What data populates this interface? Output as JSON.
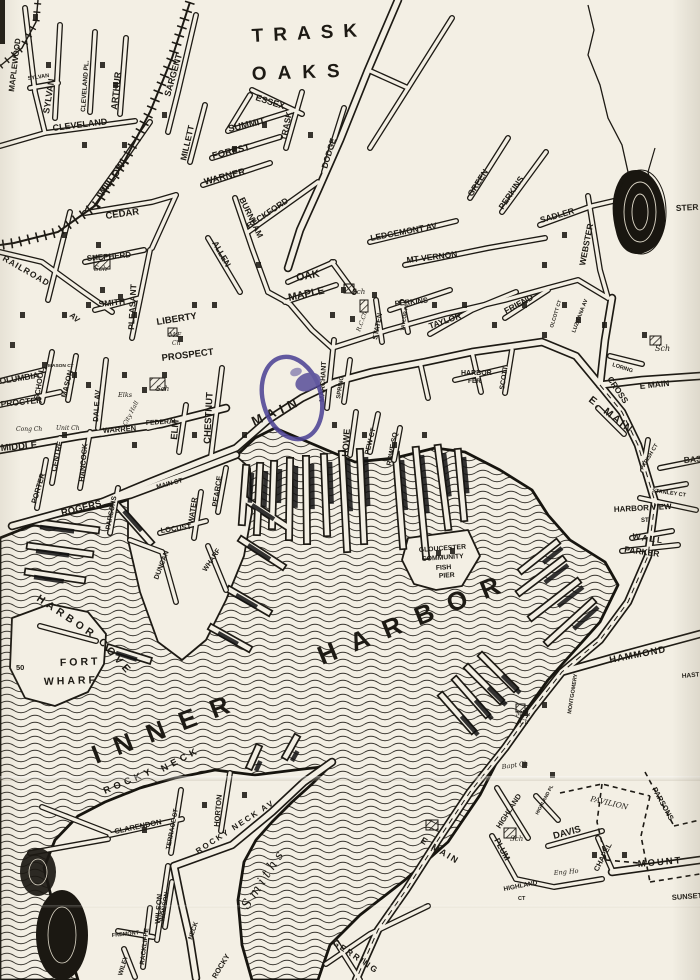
{
  "map": {
    "title": "Hand-drawn street map of Gloucester Inner Harbor",
    "colors": {
      "paper": "#f3efe4",
      "ink": "#1d1a14",
      "water_contour": "#2b2822",
      "stamp": "#4f4596"
    },
    "water_bodies": [
      "INNER HARBOR",
      "HARBOR COVE",
      "SMITHS (cove)"
    ],
    "labels": [
      {
        "t": "TRASK",
        "x": 252,
        "y": 42,
        "r": -3,
        "s": 19,
        "sp": 10
      },
      {
        "t": "OAKS",
        "x": 252,
        "y": 80,
        "r": -2,
        "s": 19,
        "sp": 11
      },
      {
        "t": "MAPLEWOOD",
        "x": 14,
        "y": 92,
        "r": -83,
        "s": 8
      },
      {
        "t": "SYLVAN",
        "x": 28,
        "y": 80,
        "r": -8,
        "s": 5.5
      },
      {
        "t": "SYLVAN",
        "x": 49,
        "y": 114,
        "r": -81,
        "s": 9
      },
      {
        "t": "CLEVELAND PL.",
        "x": 85,
        "y": 112,
        "r": -86,
        "s": 6.5
      },
      {
        "t": "ARTHUR",
        "x": 117,
        "y": 110,
        "r": -84,
        "s": 9
      },
      {
        "t": "CLEVELAND",
        "x": 53,
        "y": 131,
        "r": -7,
        "s": 9
      },
      {
        "t": "WILLOW",
        "x": 103,
        "y": 197,
        "r": -55,
        "s": 9.5
      },
      {
        "t": "SARGENT",
        "x": 170,
        "y": 97,
        "r": -74,
        "s": 9
      },
      {
        "t": "MILLETT",
        "x": 186,
        "y": 161,
        "r": -77,
        "s": 8.5
      },
      {
        "t": "ESSEX",
        "x": 255,
        "y": 100,
        "r": 18,
        "s": 9
      },
      {
        "t": "SUMMIT",
        "x": 229,
        "y": 132,
        "r": -13,
        "s": 9.5
      },
      {
        "t": "FOREST",
        "x": 213,
        "y": 159,
        "r": -14,
        "s": 9.5
      },
      {
        "t": "WARNER",
        "x": 205,
        "y": 185,
        "r": -15,
        "s": 9.5
      },
      {
        "t": "TRASK",
        "x": 286,
        "y": 141,
        "r": -78,
        "s": 8.5
      },
      {
        "t": "DODGE",
        "x": 327,
        "y": 169,
        "r": -73,
        "s": 8.5
      },
      {
        "t": "BECKFORD",
        "x": 249,
        "y": 229,
        "r": -34,
        "s": 8.5
      },
      {
        "t": "BURNHAM",
        "x": 239,
        "y": 199,
        "r": 64,
        "s": 8.5
      },
      {
        "t": "CEDAR",
        "x": 106,
        "y": 219,
        "r": -8,
        "s": 9.5
      },
      {
        "t": "SHEPHERD",
        "x": 87,
        "y": 261,
        "r": -5,
        "s": 8
      },
      {
        "t": "SMITH",
        "x": 99,
        "y": 307,
        "r": -6,
        "s": 8.5
      },
      {
        "t": "RAILROAD",
        "x": 2,
        "y": 260,
        "r": 30,
        "s": 8.5,
        "sp": 1
      },
      {
        "t": "AV",
        "x": 69,
        "y": 316,
        "r": 42,
        "s": 8
      },
      {
        "t": "PLEASANT",
        "x": 134,
        "y": 330,
        "r": -87,
        "s": 8.5
      },
      {
        "t": "ALLEN",
        "x": 212,
        "y": 243,
        "r": 60,
        "s": 8.5
      },
      {
        "t": "OAK",
        "x": 297,
        "y": 281,
        "r": -11,
        "s": 10.5
      },
      {
        "t": "MAPLE",
        "x": 289,
        "y": 301,
        "r": -12,
        "s": 10.5
      },
      {
        "t": "LEDGEMONT AV",
        "x": 371,
        "y": 241,
        "r": -11,
        "s": 8.5
      },
      {
        "t": "MT VERNON",
        "x": 407,
        "y": 263,
        "r": -7,
        "s": 8.5
      },
      {
        "t": "GREEN",
        "x": 472,
        "y": 197,
        "r": -57,
        "s": 8.5
      },
      {
        "t": "PERKINS",
        "x": 503,
        "y": 210,
        "r": -56,
        "s": 8.5
      },
      {
        "t": "SADLER",
        "x": 541,
        "y": 223,
        "r": -16,
        "s": 8.5
      },
      {
        "t": "WEBSTER",
        "x": 585,
        "y": 266,
        "r": -79,
        "s": 8.5
      },
      {
        "t": "STER",
        "x": 676,
        "y": 211,
        "r": -3,
        "s": 8.5
      },
      {
        "t": "LIBERTY",
        "x": 157,
        "y": 325,
        "r": -9,
        "s": 9.5
      },
      {
        "t": "PROSPECT",
        "x": 162,
        "y": 361,
        "r": -7,
        "s": 9.5
      },
      {
        "t": "M.E.",
        "x": 169,
        "y": 337,
        "r": 0,
        "s": 6,
        "f": "script"
      },
      {
        "t": "Ch",
        "x": 172,
        "y": 345,
        "r": 0,
        "s": 6,
        "f": "script"
      },
      {
        "t": "Sch",
        "x": 94,
        "y": 271,
        "r": 0,
        "s": 7,
        "f": "script"
      },
      {
        "t": "Sch",
        "x": 352,
        "y": 294,
        "r": 0,
        "s": 7,
        "f": "script"
      },
      {
        "t": "R.C.Ch",
        "x": 360,
        "y": 332,
        "r": -70,
        "s": 6,
        "f": "script"
      },
      {
        "t": "PERKINS",
        "x": 395,
        "y": 306,
        "r": -6,
        "s": 7.5
      },
      {
        "t": "STATEN",
        "x": 377,
        "y": 340,
        "r": -79,
        "s": 7
      },
      {
        "t": "TAYLOR",
        "x": 430,
        "y": 329,
        "r": -19,
        "s": 8.5
      },
      {
        "t": "TAYLOR PL",
        "x": 404,
        "y": 331,
        "r": -81,
        "s": 5
      },
      {
        "t": "FRIEND",
        "x": 506,
        "y": 314,
        "r": -28,
        "s": 8.5
      },
      {
        "t": "OLCOTT CT",
        "x": 553,
        "y": 328,
        "r": -73,
        "s": 5
      },
      {
        "t": "LUZITANA AV",
        "x": 575,
        "y": 333,
        "r": -69,
        "s": 5.5
      },
      {
        "t": "MARCHANT",
        "x": 324,
        "y": 402,
        "r": -87,
        "s": 7
      },
      {
        "t": "SPRING",
        "x": 340,
        "y": 399,
        "r": -81,
        "s": 6
      },
      {
        "t": "MAIN",
        "x": 254,
        "y": 426,
        "r": -24,
        "s": 13,
        "sp": 5
      },
      {
        "t": "MAIN ST",
        "x": 157,
        "y": 489,
        "r": -15,
        "s": 6.5
      },
      {
        "t": "HOWE",
        "x": 348,
        "y": 457,
        "r": -86,
        "s": 9
      },
      {
        "t": "PEW CT",
        "x": 369,
        "y": 455,
        "r": -76,
        "s": 7
      },
      {
        "t": "ROWE SQ",
        "x": 391,
        "y": 466,
        "r": -79,
        "s": 7
      },
      {
        "t": "HARBOR",
        "x": 461,
        "y": 375,
        "r": 0,
        "s": 7
      },
      {
        "t": "FER",
        "x": 468,
        "y": 383,
        "r": 0,
        "s": 6.5
      },
      {
        "t": "SCOTT",
        "x": 504,
        "y": 390,
        "r": -81,
        "s": 7
      },
      {
        "t": "E MAIN",
        "x": 640,
        "y": 389,
        "r": -6,
        "s": 8.5
      },
      {
        "t": "CROSS",
        "x": 607,
        "y": 379,
        "r": 56,
        "s": 8.5
      },
      {
        "t": "LORING",
        "x": 612,
        "y": 366,
        "r": 18,
        "s": 5.5
      },
      {
        "t": "Sch",
        "x": 655,
        "y": 351,
        "r": 0,
        "s": 8,
        "f": "script"
      },
      {
        "t": "E. MAIN",
        "x": 588,
        "y": 401,
        "r": 38,
        "s": 10.5,
        "sp": 2
      },
      {
        "t": "BASS",
        "x": 684,
        "y": 463,
        "r": -5,
        "s": 8.5
      },
      {
        "t": "COLUMBIA",
        "x": -6,
        "y": 385,
        "r": -9,
        "s": 8.5
      },
      {
        "t": "PROCTER",
        "x": 1,
        "y": 407,
        "r": -6,
        "s": 8.5
      },
      {
        "t": "MIDDLE",
        "x": 1,
        "y": 451,
        "r": -5,
        "s": 9.5
      },
      {
        "t": "SCHOOL",
        "x": 39,
        "y": 400,
        "r": -81,
        "s": 7.5
      },
      {
        "t": "MASON CT",
        "x": 48,
        "y": 367,
        "r": 0,
        "s": 4.8
      },
      {
        "t": "MASON",
        "x": 66,
        "y": 398,
        "r": -76,
        "s": 7.5
      },
      {
        "t": "DALE AV",
        "x": 98,
        "y": 422,
        "r": -86,
        "s": 7.5
      },
      {
        "t": "Elks",
        "x": 118,
        "y": 397,
        "r": 0,
        "s": 6.5,
        "f": "script"
      },
      {
        "t": "City Hall",
        "x": 126,
        "y": 426,
        "r": -62,
        "s": 6,
        "f": "script"
      },
      {
        "t": "WARREN",
        "x": 103,
        "y": 433,
        "r": -4,
        "s": 7.5
      },
      {
        "t": "FEDERAL",
        "x": 146,
        "y": 425,
        "r": -3,
        "s": 6.8
      },
      {
        "t": "ELM",
        "x": 177,
        "y": 440,
        "r": -85,
        "s": 9.5
      },
      {
        "t": "CHESTNUT",
        "x": 210,
        "y": 444,
        "r": -87,
        "s": 9.5
      },
      {
        "t": "Sch",
        "x": 156,
        "y": 391,
        "r": 0,
        "s": 7,
        "f": "script"
      },
      {
        "t": "Cong Ch",
        "x": 16,
        "y": 431,
        "r": 0,
        "s": 6,
        "f": "script"
      },
      {
        "t": "Unit Ch",
        "x": 56,
        "y": 430,
        "r": 0,
        "s": 6,
        "f": "script"
      },
      {
        "t": "CENTRE",
        "x": 56,
        "y": 472,
        "r": -78,
        "s": 7.5
      },
      {
        "t": "HANCOCK",
        "x": 84,
        "y": 482,
        "r": -85,
        "s": 7.5
      },
      {
        "t": "PORTER",
        "x": 36,
        "y": 504,
        "r": -73,
        "s": 7.5
      },
      {
        "t": "ROGERS",
        "x": 62,
        "y": 516,
        "r": -14,
        "s": 9.5
      },
      {
        "t": "PARSONS",
        "x": 110,
        "y": 530,
        "r": -79,
        "s": 7
      },
      {
        "t": "LOCUST",
        "x": 161,
        "y": 533,
        "r": -8,
        "s": 7.5
      },
      {
        "t": "WATER",
        "x": 193,
        "y": 524,
        "r": -81,
        "s": 7.5
      },
      {
        "t": "PEARCE",
        "x": 217,
        "y": 507,
        "r": -81,
        "s": 7.5
      },
      {
        "t": "WHARF",
        "x": 206,
        "y": 572,
        "r": -56,
        "s": 7
      },
      {
        "t": "DUNCAN",
        "x": 158,
        "y": 580,
        "r": -69,
        "s": 7
      },
      {
        "t": "HARBOR",
        "x": 36,
        "y": 600,
        "r": 34,
        "s": 10.5,
        "sp": 4
      },
      {
        "t": "COVE",
        "x": 98,
        "y": 642,
        "r": 48,
        "s": 10.5,
        "sp": 4
      },
      {
        "t": "FORT",
        "x": 60,
        "y": 666,
        "r": -2,
        "s": 10.5,
        "sp": 3
      },
      {
        "t": "WHARF",
        "x": 44,
        "y": 685,
        "r": -2,
        "s": 10.5,
        "sp": 3
      },
      {
        "t": "50",
        "x": 16,
        "y": 670,
        "r": 0,
        "s": 7.5
      },
      {
        "t": "GLOUCESTER",
        "x": 419,
        "y": 552,
        "r": -4,
        "s": 6.8
      },
      {
        "t": "COMMUNITY",
        "x": 422,
        "y": 561,
        "r": -4,
        "s": 6.8
      },
      {
        "t": "FISH",
        "x": 436,
        "y": 570,
        "r": -4,
        "s": 6.8
      },
      {
        "t": "PIER",
        "x": 439,
        "y": 578,
        "r": -4,
        "s": 6.8
      },
      {
        "t": "INNER",
        "x": 96,
        "y": 764,
        "r": -21,
        "s": 26,
        "sp": 16
      },
      {
        "t": "HARBOR",
        "x": 322,
        "y": 665,
        "r": -22,
        "s": 26,
        "sp": 16
      },
      {
        "t": "HARBOR VIEW",
        "x": 614,
        "y": 512,
        "r": -3,
        "s": 8
      },
      {
        "t": "ST",
        "x": 641,
        "y": 522,
        "r": 0,
        "s": 6
      },
      {
        "t": "WALL",
        "x": 632,
        "y": 539,
        "r": 8,
        "s": 8.5,
        "sp": 2
      },
      {
        "t": "PARKER",
        "x": 624,
        "y": 552,
        "r": 8,
        "s": 8.5
      },
      {
        "t": "STANLEY CT",
        "x": 652,
        "y": 492,
        "r": 8,
        "s": 5.5
      },
      {
        "t": "PARISH CT",
        "x": 643,
        "y": 470,
        "r": -59,
        "s": 5.5
      },
      {
        "t": "HAMMOND",
        "x": 610,
        "y": 663,
        "r": -11,
        "s": 9.5,
        "sp": 1
      },
      {
        "t": "HAST",
        "x": 682,
        "y": 678,
        "r": -5,
        "s": 6.5
      },
      {
        "t": "M.E.",
        "x": 516,
        "y": 716,
        "r": 0,
        "s": 6,
        "f": "script"
      },
      {
        "t": "Ch",
        "x": 520,
        "y": 724,
        "r": 0,
        "s": 6,
        "f": "script"
      },
      {
        "t": "Bapt Ch",
        "x": 502,
        "y": 769,
        "r": -8,
        "s": 6.5,
        "f": "script"
      },
      {
        "t": "MONTGOMERY",
        "x": 571,
        "y": 714,
        "r": -81,
        "s": 5.5
      },
      {
        "t": "CHAPEL",
        "x": 598,
        "y": 872,
        "r": -63,
        "s": 7.5
      },
      {
        "t": "MOUNT",
        "x": 638,
        "y": 867,
        "r": -5,
        "s": 9.5,
        "sp": 2
      },
      {
        "t": "DAVIS",
        "x": 554,
        "y": 839,
        "r": -15,
        "s": 9.5
      },
      {
        "t": "PLUM",
        "x": 494,
        "y": 840,
        "r": 62,
        "s": 8.5
      },
      {
        "t": "HIGHLAND",
        "x": 500,
        "y": 829,
        "r": -57,
        "s": 7.5
      },
      {
        "t": "HIGHLAND PL",
        "x": 538,
        "y": 815,
        "r": -62,
        "s": 4.8
      },
      {
        "t": "Sch",
        "x": 510,
        "y": 841,
        "r": 0,
        "s": 7,
        "f": "script"
      },
      {
        "t": "Eng Ho",
        "x": 554,
        "y": 875,
        "r": -5,
        "s": 6.5,
        "f": "script"
      },
      {
        "t": "HIGHLAND",
        "x": 504,
        "y": 891,
        "r": -11,
        "s": 6.5
      },
      {
        "t": "CT",
        "x": 518,
        "y": 900,
        "r": 0,
        "s": 5.5
      },
      {
        "t": "SUNSET",
        "x": 672,
        "y": 900,
        "r": -4,
        "s": 7.5
      },
      {
        "t": "PAVILION",
        "x": 590,
        "y": 801,
        "r": 13,
        "s": 7.5,
        "f": "script"
      },
      {
        "t": "PARSONS",
        "x": 652,
        "y": 789,
        "r": 61,
        "s": 7.5
      },
      {
        "t": "ROCKY",
        "x": 105,
        "y": 794,
        "r": -23,
        "s": 9.5,
        "sp": 4
      },
      {
        "t": "NECK",
        "x": 163,
        "y": 772,
        "r": -28,
        "s": 9.5,
        "sp": 4
      },
      {
        "t": "CLARENDON",
        "x": 115,
        "y": 834,
        "r": -12,
        "s": 7.5
      },
      {
        "t": "TERRACE ST",
        "x": 170,
        "y": 850,
        "r": -79,
        "s": 6.5
      },
      {
        "t": "HORTON",
        "x": 219,
        "y": 827,
        "r": -85,
        "s": 7.5
      },
      {
        "t": "ROCKY NECK AV",
        "x": 198,
        "y": 854,
        "r": -33,
        "s": 8,
        "sp": 2
      },
      {
        "t": "WILSON",
        "x": 160,
        "y": 924,
        "r": -86,
        "s": 7.5
      },
      {
        "t": "RACKLIFFE",
        "x": 144,
        "y": 965,
        "r": -83,
        "s": 6.5
      },
      {
        "t": "WONSON",
        "x": 164,
        "y": 922,
        "r": -81,
        "s": 6.5
      },
      {
        "t": "FREMONT",
        "x": 112,
        "y": 937,
        "r": -6,
        "s": 5.5
      },
      {
        "t": "WILEY",
        "x": 122,
        "y": 976,
        "r": -73,
        "s": 6.5
      },
      {
        "t": "NECK",
        "x": 192,
        "y": 940,
        "r": -71,
        "s": 6.5
      },
      {
        "t": "ROCKY",
        "x": 216,
        "y": 979,
        "r": -59,
        "s": 7.5
      },
      {
        "t": "GERRING",
        "x": 332,
        "y": 944,
        "r": 34,
        "s": 8.5,
        "sp": 2
      },
      {
        "t": "E MAIN",
        "x": 420,
        "y": 842,
        "r": 31,
        "s": 9,
        "sp": 2
      },
      {
        "t": "Smiths",
        "x": 248,
        "y": 910,
        "r": -57,
        "s": 13,
        "sp": 4,
        "f": "script"
      }
    ]
  }
}
